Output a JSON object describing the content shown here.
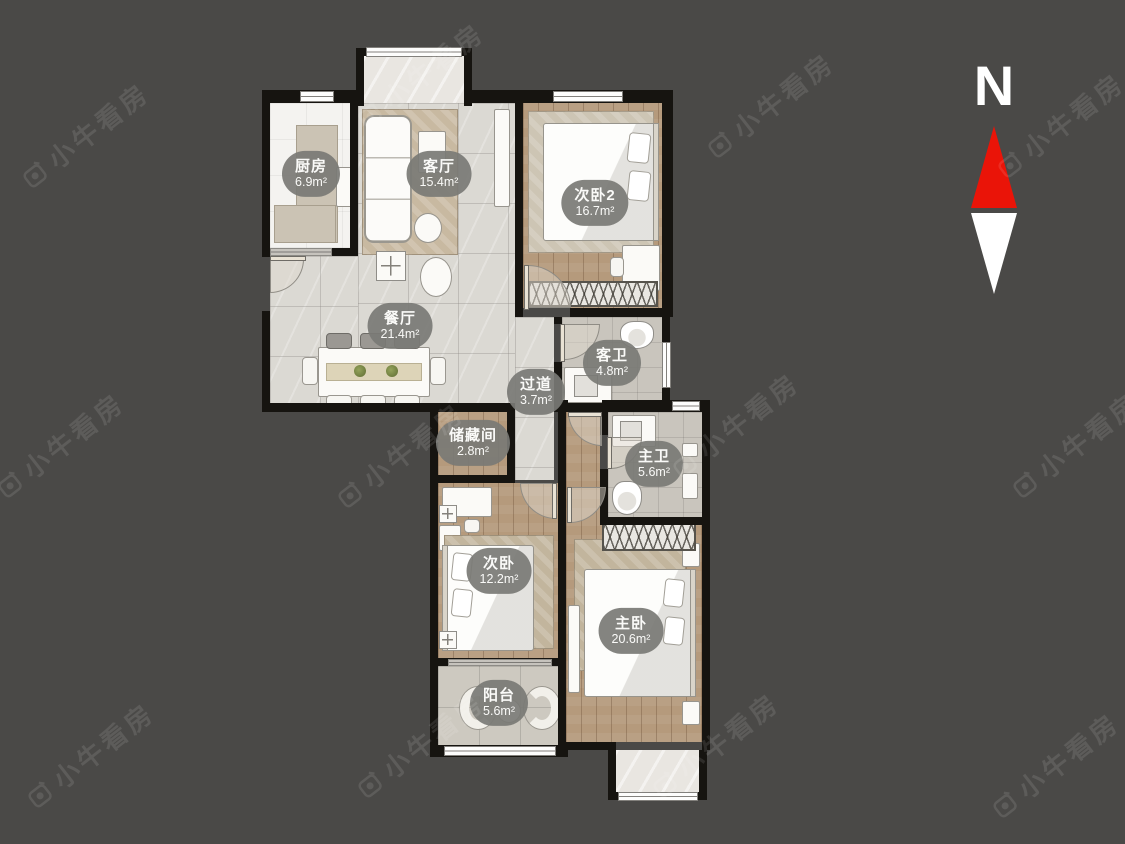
{
  "page": {
    "background_color": "#4a4947"
  },
  "watermark": {
    "text": "小牛看房"
  },
  "compass": {
    "label": "N"
  },
  "colors": {
    "background": "#4a4947",
    "wall": "#161410",
    "arrow_red": "#ea1408",
    "arrow_white": "#ffffff",
    "label_pill": "rgba(122,121,117,0.92)",
    "wood_floor": "#b59a7c",
    "marble_floor": "#dbd9d3"
  },
  "floor_plan": {
    "rooms": [
      {
        "id": "kitchen",
        "name": "厨房",
        "area": "6.9m²"
      },
      {
        "id": "living",
        "name": "客厅",
        "area": "15.4m²"
      },
      {
        "id": "bedroom2",
        "name": "次卧2",
        "area": "16.7m²"
      },
      {
        "id": "dining",
        "name": "餐厅",
        "area": "21.4m²"
      },
      {
        "id": "guest-bath",
        "name": "客卫",
        "area": "4.8m²"
      },
      {
        "id": "hallway",
        "name": "过道",
        "area": "3.7m²"
      },
      {
        "id": "storage",
        "name": "储藏间",
        "area": "2.8m²"
      },
      {
        "id": "master-bath",
        "name": "主卫",
        "area": "5.6m²"
      },
      {
        "id": "bedroom",
        "name": "次卧",
        "area": "12.2m²"
      },
      {
        "id": "master-bedroom",
        "name": "主卧",
        "area": "20.6m²"
      },
      {
        "id": "balcony",
        "name": "阳台",
        "area": "5.6m²"
      }
    ]
  }
}
